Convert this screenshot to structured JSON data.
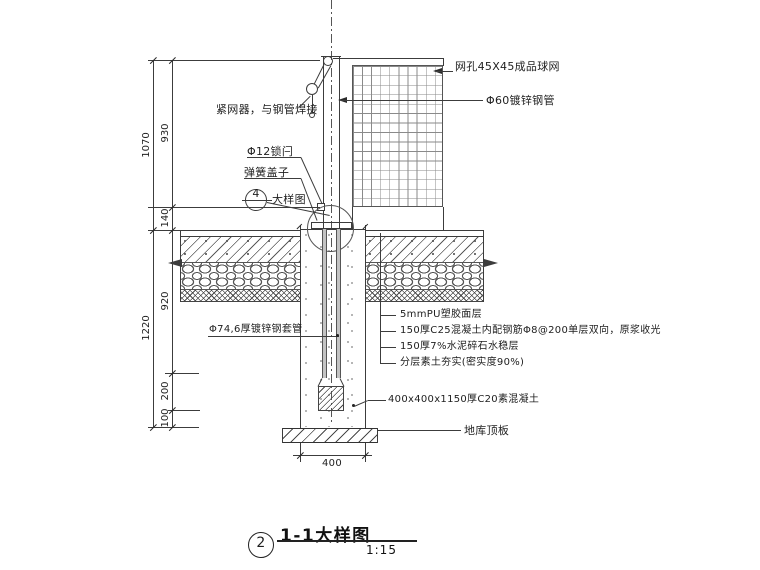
{
  "drawing": {
    "callouts": {
      "net": "网孔45X45成品球网",
      "pipe": "Φ60镀锌钢管",
      "tensioner": "紧网器，与钢管焊接",
      "latch": "Φ12锁闩",
      "spring_cover": "弹簧盖子",
      "detail_ref_number": "4",
      "detail_ref_label": "大样图",
      "sleeve": "Φ74,6厚镀锌钢套管",
      "layer_labels": [
        "5mmPU塑胶面层",
        "150厚C25混凝土内配钢筋Φ8@200单层双向，原浆收光",
        "150厚7%水泥碎石水稳层",
        "分层素土夯实(密实度90%)"
      ],
      "footing": "400x400x1150厚C20素混凝土",
      "slab": "地库顶板"
    },
    "dimensions": {
      "left_outer": [
        "1070",
        "1220"
      ],
      "left_inner": [
        "930",
        "140",
        "920",
        "200",
        "100"
      ],
      "bottom_width": "400"
    },
    "title_block": {
      "number": "2",
      "title": "1-1大样图",
      "scale": "1:15"
    },
    "colors": {
      "line": "#3c3c3c",
      "background": "#ffffff"
    }
  }
}
